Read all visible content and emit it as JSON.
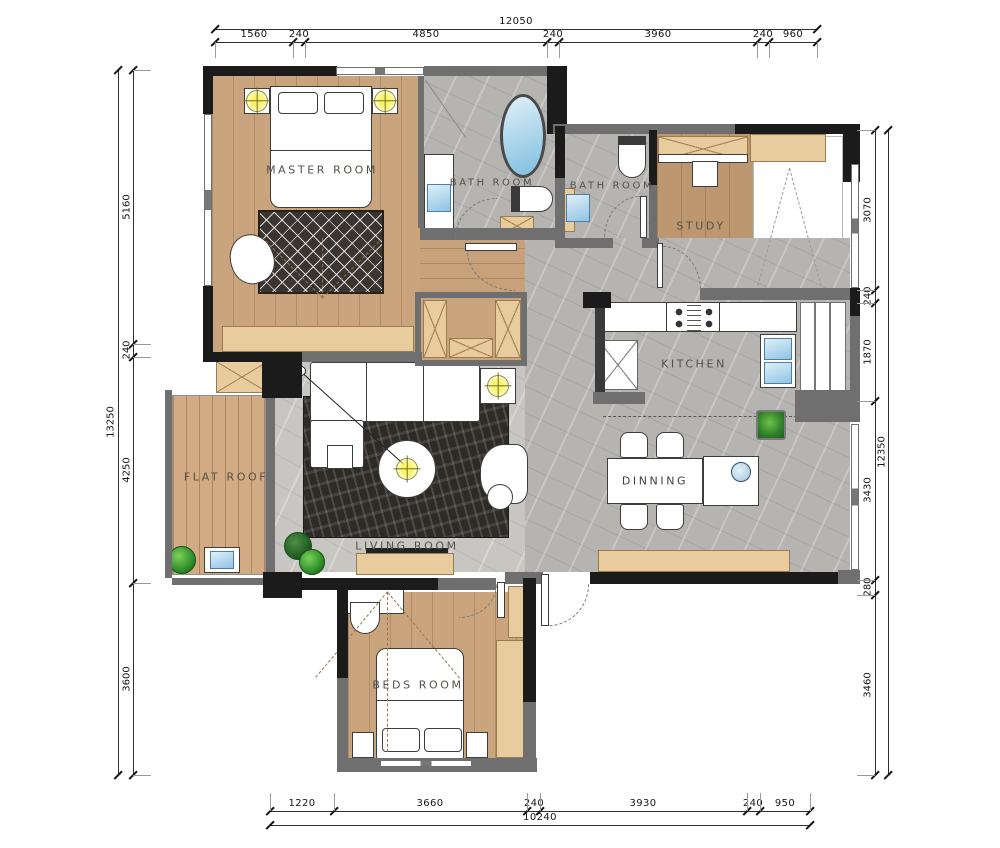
{
  "plan_title": "apartment-floor-plan",
  "rooms": {
    "master": "MASTER ROOM",
    "bath1": "BATH ROOM",
    "bath2": "BATH ROOM",
    "study": "STUDY",
    "kitchen": "KITCHEN",
    "dining": "DINNING",
    "living": "LIVING ROOM",
    "flat_roof": "FLAT ROOF",
    "beds": "BEDS ROOM"
  },
  "dimensions": {
    "top": {
      "total": "12050",
      "segments": [
        "1560",
        "240",
        "4850",
        "240",
        "3960",
        "240",
        "960"
      ]
    },
    "bottom": {
      "total": "10240",
      "segments": [
        "1220",
        "3660",
        "240",
        "3930",
        "240",
        "950"
      ]
    },
    "left": {
      "total": "13250",
      "segments": [
        "5160",
        "240",
        "4250",
        "3600"
      ]
    },
    "right": {
      "total": "12350",
      "segments": [
        "3070",
        "240",
        "1870",
        "3430",
        "280",
        "3460"
      ]
    }
  },
  "colors": {
    "wall": "#1b1b1b",
    "wall_light": "#6f6f6f",
    "wood_floor": "#c9a47d",
    "tile_floor": "#b6b4b1",
    "cabinet": "#e9cc9e",
    "water_fixture": "#8fc3e4",
    "light_symbol": "#faf468",
    "plant": "#35952e"
  }
}
